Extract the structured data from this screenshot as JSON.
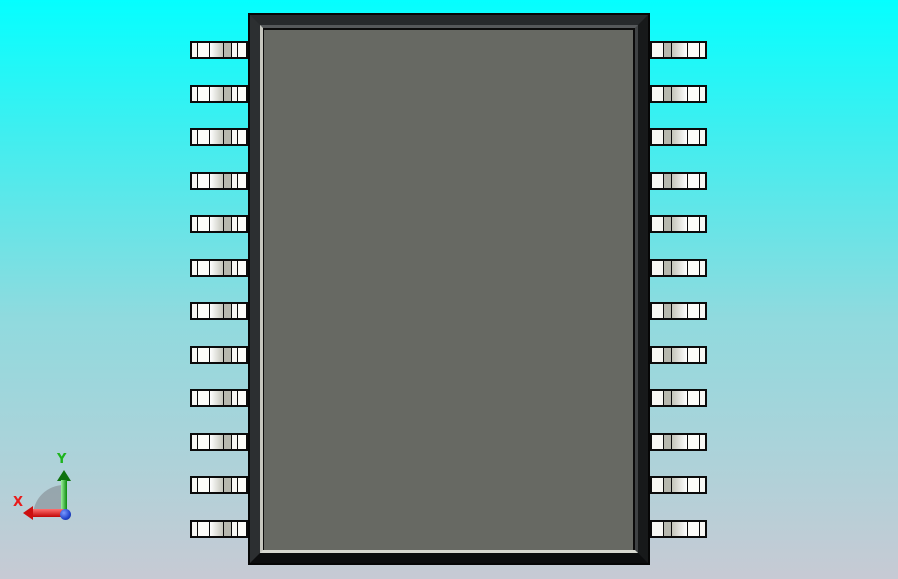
{
  "scene": {
    "description": "3D render of a dual-row surface-mount IC package",
    "view": "top"
  },
  "package": {
    "sides": 2,
    "pins_per_side": 12,
    "total_pins": 24,
    "first_pin_top": 41,
    "pin_pitch": 43.5
  },
  "axis_gizmo": {
    "x_label": "X",
    "y_label": "Y"
  },
  "colors": {
    "bg_top": "#04ffff",
    "bg_upper": "#3deff0",
    "bg_mid": "#90dade",
    "bg_lower": "#aed2d9",
    "bg_bottom": "#c7cad4",
    "body_fill": "#676963",
    "frame_top": "#26292b",
    "frame_left": "#2c2f31",
    "frame_right": "#17191a",
    "frame_bottom": "#0c0d0e",
    "outline": "#060606",
    "trim_top": "#55585a",
    "trim_left": "#c6c6be",
    "trim_right": "#3f4244",
    "trim_bottom": "#d8d8d0",
    "pin_white": "#f8f8f4",
    "pin_gray": "#b7b8ae",
    "pin_outline": "#0b0b0b",
    "axis_x": "#e81c1c",
    "axis_y": "#1db41d",
    "origin_blue": "#2244cc"
  }
}
